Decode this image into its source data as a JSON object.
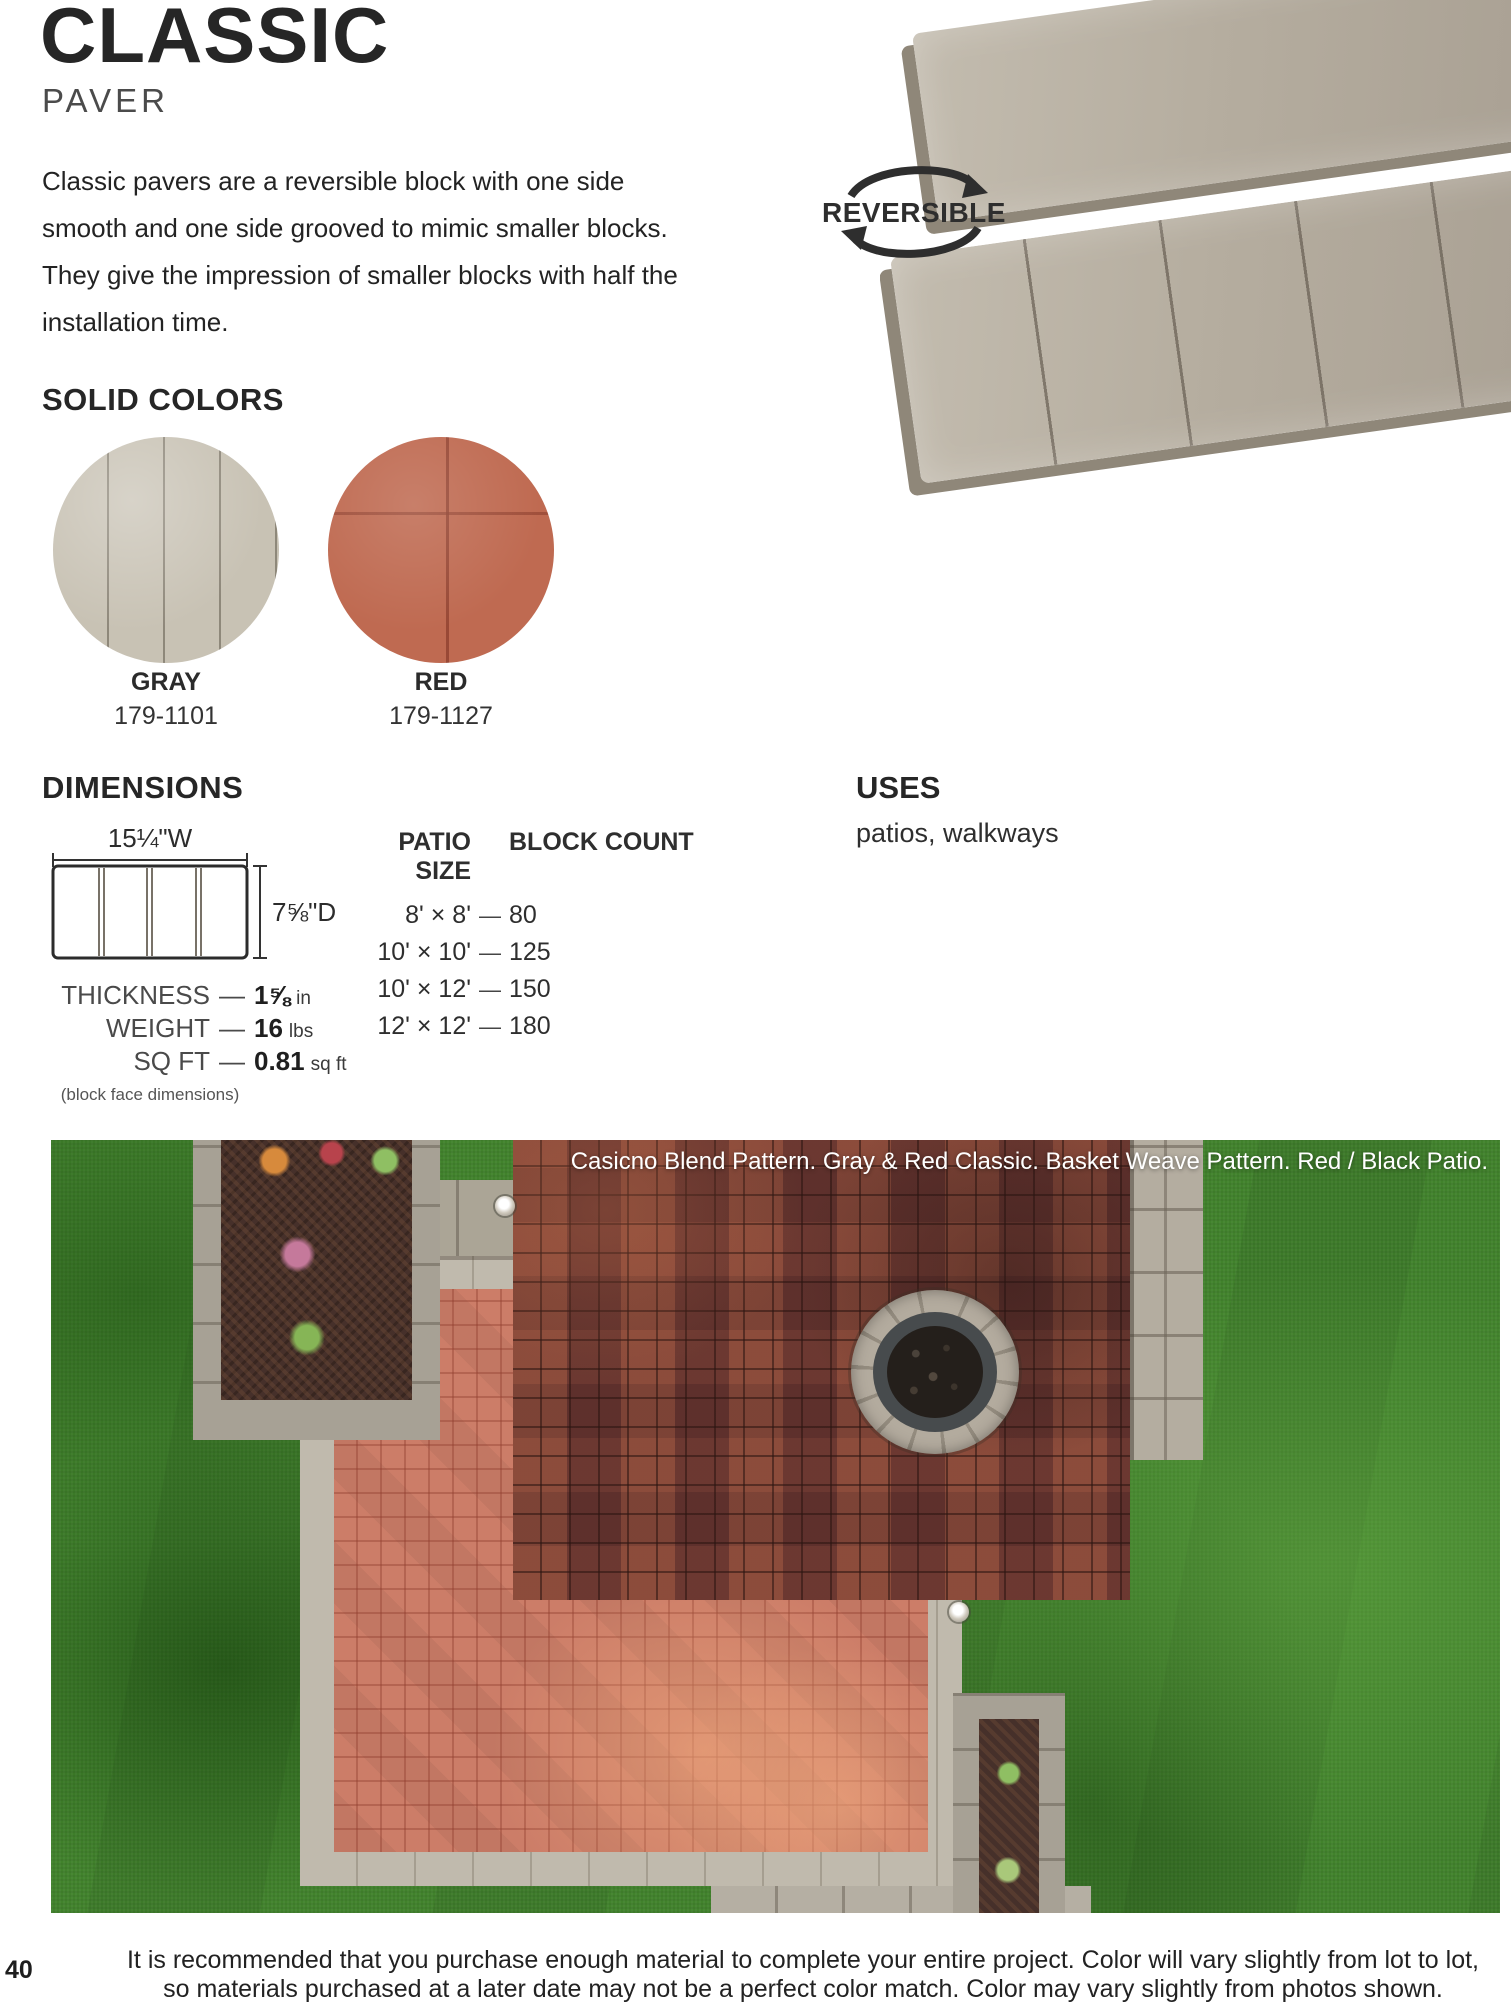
{
  "header": {
    "title": "CLASSIC",
    "subtitle": "PAVER",
    "description": "Classic pavers are a reversible block with one side smooth and one side grooved to mimic smaller blocks. They give the impression of smaller blocks with half the installation time."
  },
  "badge": {
    "label": "REVERSIBLE"
  },
  "solid_colors": {
    "heading": "SOLID COLORS",
    "swatches": [
      {
        "name": "GRAY",
        "code": "179-1101",
        "color": "#c8c2b4"
      },
      {
        "name": "RED",
        "code": "179-1127",
        "color": "#bf6a51"
      }
    ]
  },
  "dimensions": {
    "heading": "DIMENSIONS",
    "width_label": "15¼\"W",
    "depth_label": "7⅝\"D",
    "dash": "—",
    "specs": [
      {
        "label": "THICKNESS",
        "value": "1⅝",
        "unit": "in"
      },
      {
        "label": "WEIGHT",
        "value": "16",
        "unit": "lbs"
      },
      {
        "label": "SQ FT",
        "value": "0.81",
        "unit": "sq ft"
      }
    ],
    "note": "(block face dimensions)"
  },
  "patio_table": {
    "col_size": "PATIO SIZE",
    "col_count": "BLOCK COUNT",
    "dash": "—",
    "rows": [
      {
        "size": "8' × 8'",
        "count": "80"
      },
      {
        "size": "10' × 10'",
        "count": "125"
      },
      {
        "size": "10' × 12'",
        "count": "150"
      },
      {
        "size": "12' × 12'",
        "count": "180"
      }
    ]
  },
  "uses": {
    "heading": "USES",
    "text": "patios, walkways"
  },
  "photo": {
    "caption": "Casicno Blend Pattern. Gray & Red Classic. Basket Weave Pattern. Red / Black Patio."
  },
  "footer": {
    "line1": "It is recommended that you purchase enough material to complete your entire project. Color will vary slightly from lot to lot,",
    "line2": "so materials purchased at a later date may not be a perfect color match. Color may vary slightly from photos shown.",
    "page_number": "40"
  }
}
